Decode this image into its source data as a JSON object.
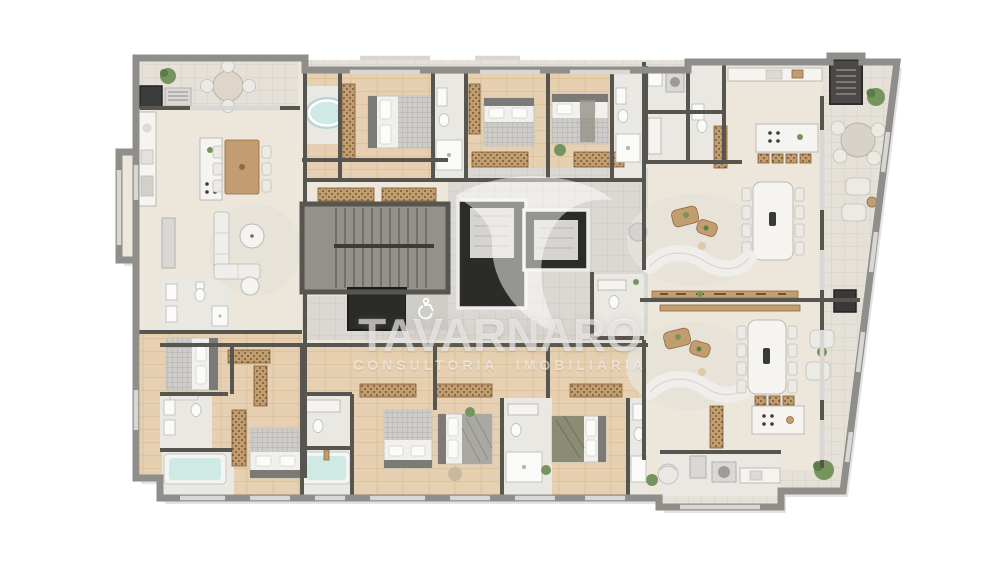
{
  "watermark": {
    "title": "TAVARNARO",
    "subtitle": "CONSULTORIA IMOBILIÁRIA",
    "logo": "swoosh-logo"
  },
  "plan": {
    "kind": "residential floor plan, top-down 3D render",
    "elements": [
      "staircase",
      "elevator",
      "elevator-shaft",
      "accessible-lobby",
      "wheelchair-icon",
      "hot-tub",
      "bathtub",
      "shower",
      "toilet",
      "sink",
      "double-bed",
      "wardrobe",
      "kitchen-island",
      "kitchen-counter",
      "dining-table",
      "round-terrace-table",
      "curved-sofa",
      "l-shaped-sofa",
      "lounge-chair",
      "coffee-table",
      "console-shelf",
      "washer",
      "barbecue-grill",
      "plant",
      "rug",
      "balcony"
    ]
  },
  "palette": {
    "background": "#ffffff",
    "wall_dark": "#56554f",
    "wall_mid": "#8f8e8a",
    "floor_cream": "#ece6db",
    "floor_wood": "#e6d0b1",
    "floor_tile": "#e5e1d8",
    "floor_gray": "#dbd8d3",
    "stair_floor": "#94908a",
    "shaft": "#2b2b29",
    "elevator_panel": "#d6d4d0",
    "water": "#cfe9e5",
    "plant": "#76955e",
    "plant_dark": "#5c7c49",
    "wood": "#c29d6f",
    "wood_dark": "#8f6a42",
    "white_furniture": "#f5f4f1",
    "sofa": "#efeeea",
    "rug": "#e7e2d8",
    "bed_blanket": "#cdccc8",
    "bed_sheet": "#f1f0ed",
    "olive": "#8c8c74"
  }
}
